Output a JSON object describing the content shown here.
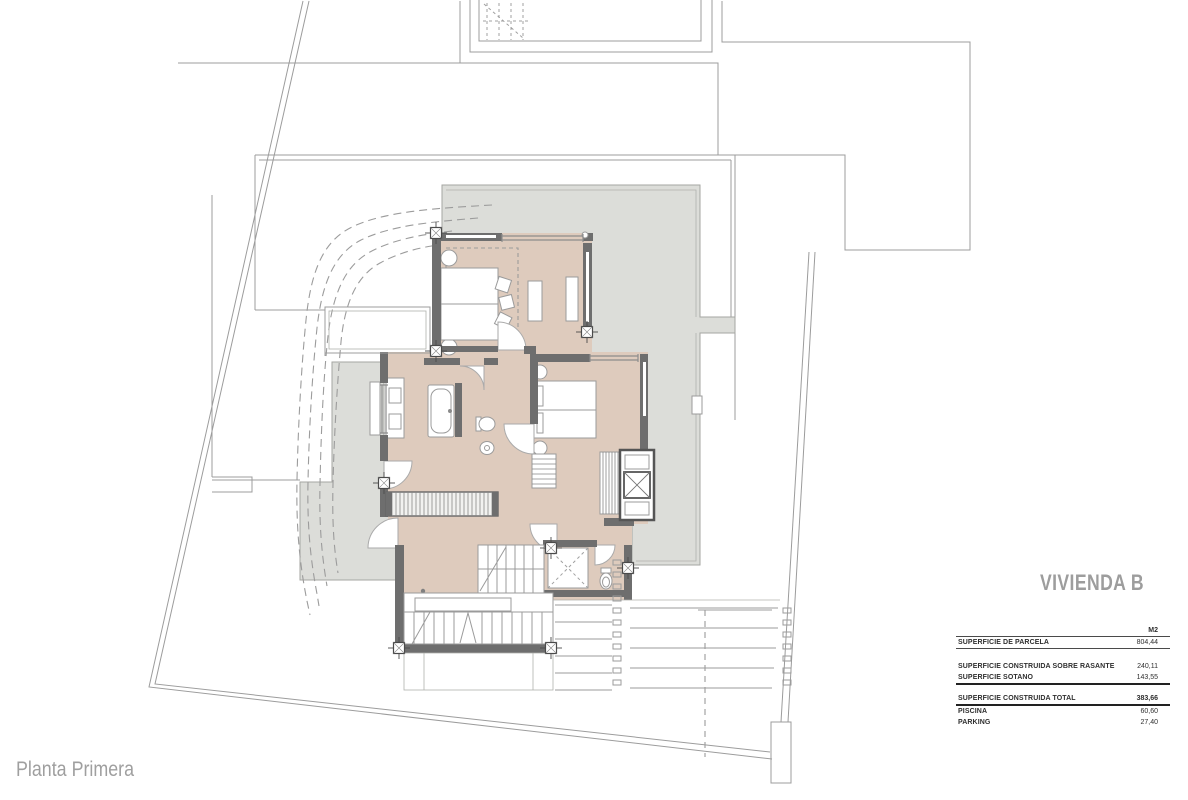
{
  "title": "VIVIENDA B",
  "plan_label": "Planta Primera",
  "table": {
    "unit_header": "M2",
    "rows": [
      {
        "label": "SUPERFICIE DE PARCELA",
        "value": "804,44"
      },
      {
        "label": "SUPERFICIE CONSTRUIDA SOBRE RASANTE",
        "value": "240,11"
      },
      {
        "label": "SUPERFICIE SOTANO",
        "value": "143,55"
      },
      {
        "label": "SUPERFICIE CONSTRUIDA TOTAL",
        "value": "383,66"
      },
      {
        "label": "PISCINA",
        "value": "60,60"
      },
      {
        "label": "PARKING",
        "value": "27,40"
      }
    ]
  },
  "colors": {
    "wall": "#6e6e6e",
    "floor": "#decbbd",
    "terrace": "#dcddd9",
    "line": "#9c9c9c",
    "text": "#2f2f2f",
    "muted": "#9e9e9e"
  }
}
